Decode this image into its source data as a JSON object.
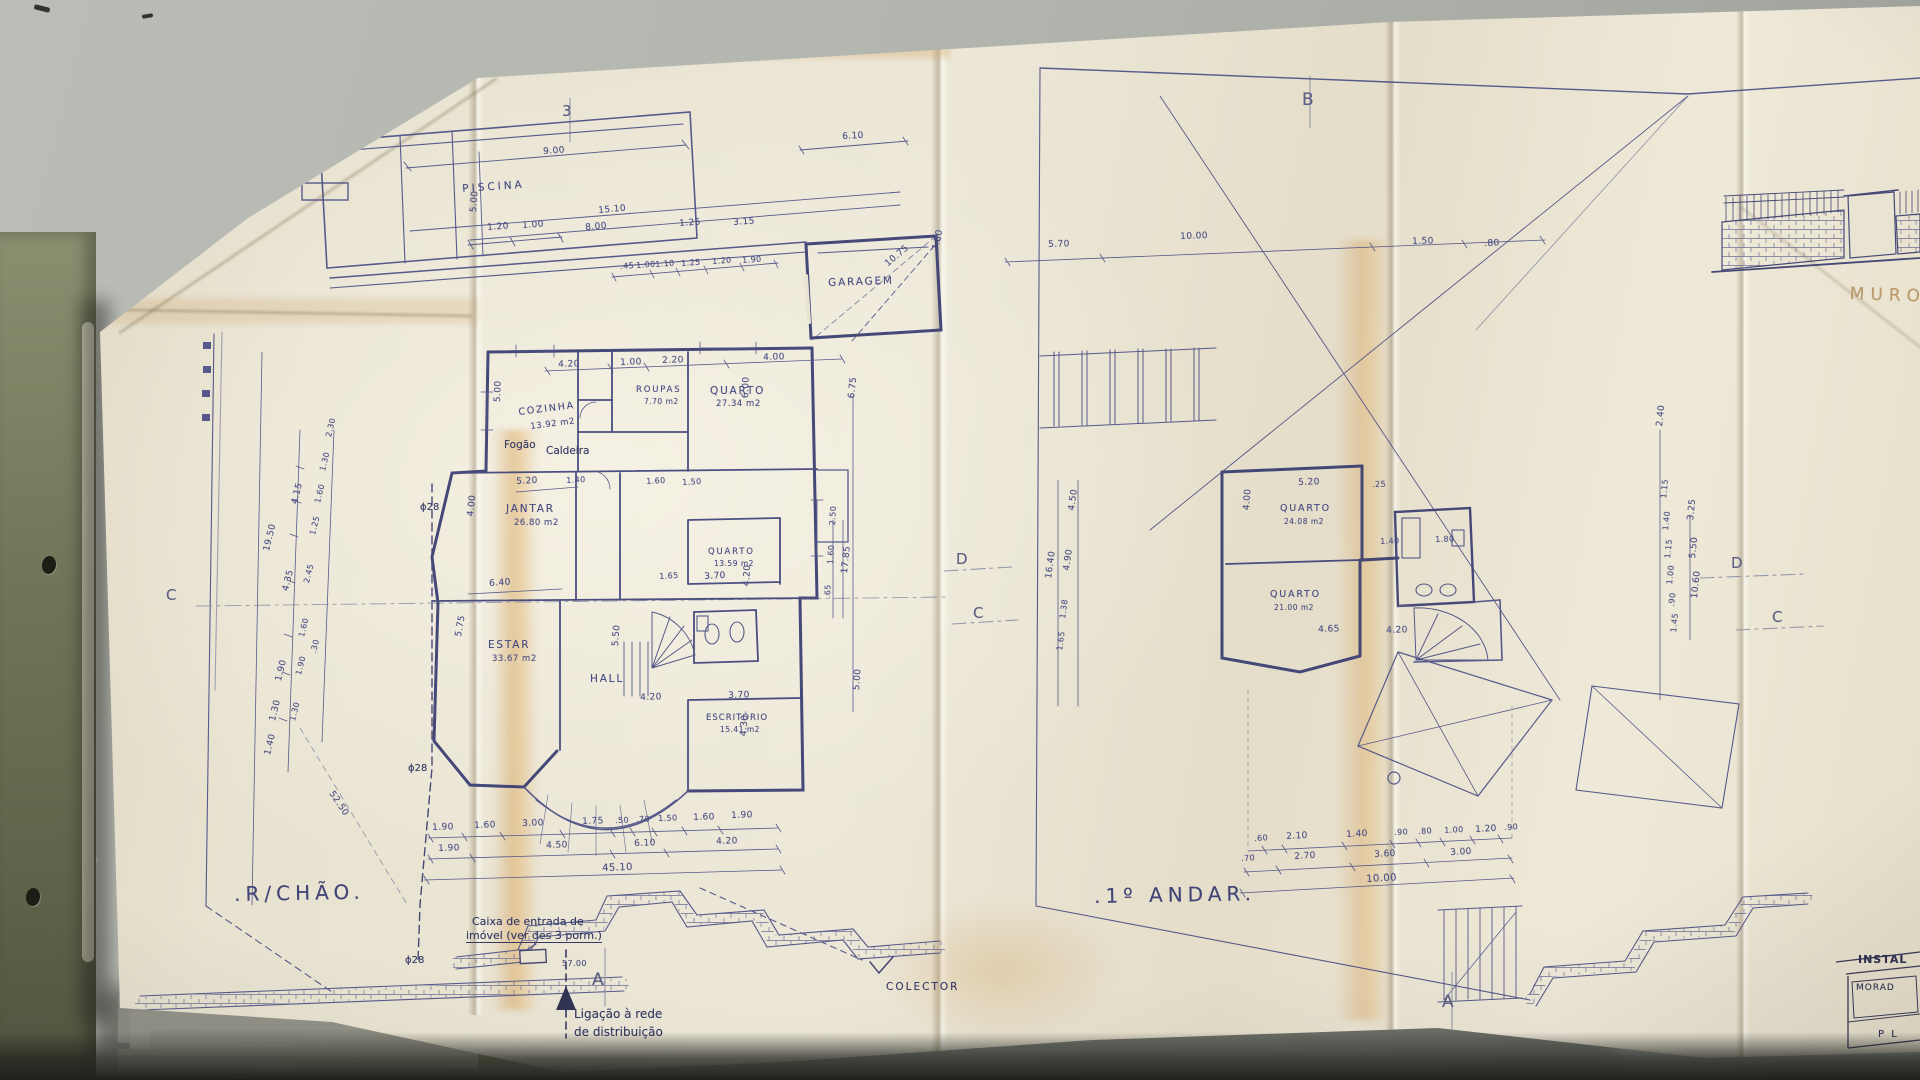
{
  "colors": {
    "paper": "#e9e3d2",
    "ink": "#4d5186",
    "wall_ink": "#3b3f72",
    "pencil": "#9094ab",
    "aged_fold": "#d6a268",
    "desk": "#b2b4ae",
    "folder_green": "#767a5c",
    "deep_shadow": "#23251f",
    "annotation_ink": "#2e3156"
  },
  "gf": {
    "name": ".R/CHÃO.",
    "rooms": [
      {
        "label": "PISCINA",
        "area": ""
      },
      {
        "label": "GARAGEM",
        "area": ""
      },
      {
        "label": "COZINHA",
        "area": "13.92 m2"
      },
      {
        "label": "ROUPAS",
        "area": "7.70 m2"
      },
      {
        "label": "QUARTO",
        "area": "27.34 m2"
      },
      {
        "label": "JANTAR",
        "area": "26.80 m2"
      },
      {
        "label": "ESTAR",
        "area": "33.67 m2"
      },
      {
        "label": "HALL",
        "area": ""
      },
      {
        "label": "QUARTO",
        "area": "13.59 m2"
      },
      {
        "label": "ESCRITÓRIO",
        "area": "15.41 m2"
      }
    ],
    "pool": [
      "9.00",
      "5.00",
      "1.20",
      "1.00",
      "15.10",
      "8.00",
      "1.25",
      "3.15",
      ".45",
      "1.00",
      "1.10",
      "1.25",
      "1.20",
      "1.90",
      "6.10",
      "10.75",
      "7.80"
    ],
    "house": [
      "4.20",
      "1.00",
      "2.20",
      "4.00",
      "5.00",
      "6.00",
      "5.20",
      "1.40",
      "1.60",
      "1.50",
      "4.00",
      "6.40",
      "1.65",
      "3.70",
      "4.20",
      "2.50",
      "1.60",
      ".65",
      "17.85",
      "5.50",
      "5.75",
      "4.20",
      "3.70",
      "4.30",
      "6.75",
      "5.00"
    ],
    "left": [
      "19.50",
      "4.15",
      "4.35",
      "1.90",
      "1.30",
      "1.40",
      "2.30",
      "1.30",
      "1.60",
      "1.25",
      "2.45",
      "1.60",
      ".30",
      "1.90",
      "1.30"
    ],
    "bottom": [
      "1.90",
      "1.60",
      "3.00",
      "1.75",
      ".50",
      ".70",
      "1.50",
      "1.60",
      "1.90",
      "1.90",
      "4.50",
      "6.10",
      "4.20",
      "45.10"
    ],
    "ann": {
      "fogao": "Fogão",
      "caldeira": "Caldeira",
      "phi": "ϕ28",
      "diag": "52.50",
      "caixa1": "Caixa de entrada de",
      "caixa2": "imóvel (ver des 3 porm.)",
      "len": "57.00",
      "liga1": "Ligação à rede",
      "liga2": "de distribuição",
      "colector": "COLECTOR"
    }
  },
  "ff": {
    "name": ".1º ANDAR.",
    "rooms": [
      {
        "label": "QUARTO",
        "area": "24.08 m2"
      },
      {
        "label": "QUARTO",
        "area": "21.00 m2"
      }
    ],
    "top": [
      "5.70",
      "10.00",
      "1.50",
      ".80"
    ],
    "left": [
      "16.40",
      "4.50",
      "4.90",
      "1.38",
      "1.65"
    ],
    "house": [
      "5.20",
      ".25",
      "4.00",
      "1.40",
      "1.80",
      "4.65",
      "4.20"
    ],
    "right": [
      "2.40",
      "1.15",
      "1.40",
      "1.15",
      "1.00",
      ".90",
      "1.45",
      "3.25",
      "5.50",
      "10.60"
    ],
    "bottom": [
      ".60",
      "2.10",
      "1.40",
      ".90",
      ".80",
      "1.00",
      "1.20",
      ".90",
      ".70",
      "2.70",
      "3.60",
      "3.00",
      "10.00"
    ]
  },
  "markers": {
    "s3": "3",
    "b": "B",
    "c": "C",
    "d": "D",
    "a": "A"
  },
  "title_block": {
    "l1": "INSTAL",
    "l2": "MORAD",
    "l3": "P L"
  },
  "misc": {
    "muro": "MURO"
  }
}
